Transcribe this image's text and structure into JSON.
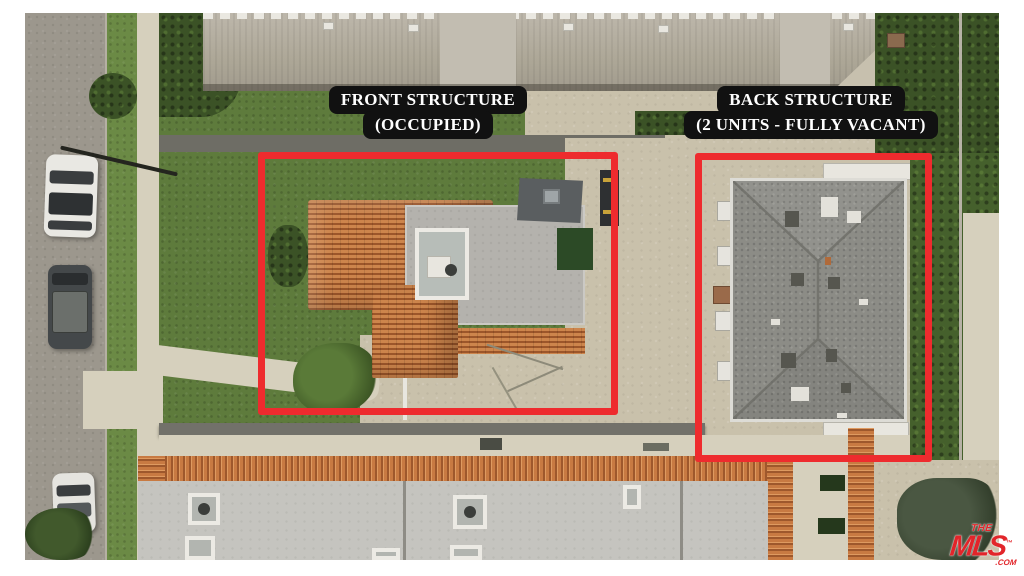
{
  "annotations": {
    "front_structure": {
      "line1": "FRONT STRUCTURE",
      "line2": "(OCCUPIED)"
    },
    "back_structure": {
      "line1": "BACK STRUCTURE",
      "line2": "(2 UNITS - FULLY VACANT)"
    }
  },
  "watermark": {
    "the": "THE",
    "mls": "MLS",
    "trademark": "™",
    "com": ".COM"
  },
  "colors": {
    "annotation_box_red": "#ee2b2e",
    "label_background": "#111111",
    "label_text": "#ffffff",
    "watermark_red": "#e2252a",
    "frame_white": "#ffffff"
  }
}
